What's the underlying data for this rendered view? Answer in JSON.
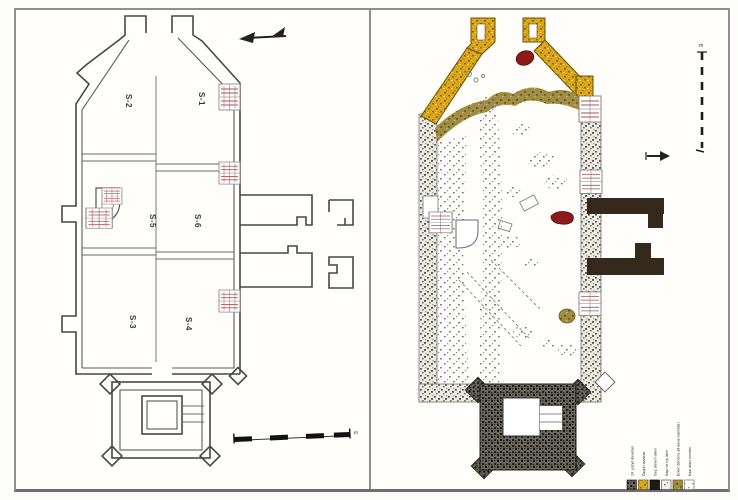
{
  "figure": {
    "title": "church-excavation-plans",
    "panel_count": 2
  },
  "left_plan": {
    "description": "line drawing of church plan with excavation trenches",
    "trenches": [
      {
        "label": "S-2"
      },
      {
        "label": "S-1"
      },
      {
        "label": "S-5"
      },
      {
        "label": "S-6"
      },
      {
        "label": "S-3"
      },
      {
        "label": "S-4"
      }
    ],
    "scale_unit": "m",
    "north_icon": "north-arrow"
  },
  "right_plan": {
    "description": "colored stone-by-stone excavation plan of same church",
    "scale_unit": "m",
    "north_icon": "north-arrow",
    "colors": {
      "yellow_walls": "#d9a61e",
      "olive_remains": "#a08c42",
      "dark_additions": "#34291a",
      "solid_black": "#1d1a12",
      "red_features": "#8c1a1a",
      "gray_walls": "#8e8c84"
    },
    "legend": {
      "entries": [
        {
          "label": "19. yüzyıl duvarları",
          "swatch": "dark-stipple"
        },
        {
          "label": "Özgün duvarlar",
          "swatch": "yellow-stipple"
        },
        {
          "label": "Geç dönem ekleri",
          "swatch": "solid-black"
        },
        {
          "label": "Kapı ve niş izleri",
          "swatch": "light"
        },
        {
          "label": "Erken döneme ait duvar kalıntıları",
          "swatch": "olive-stipple"
        },
        {
          "label": "Kazı alanı sınırları",
          "swatch": "white-stipple"
        }
      ]
    }
  }
}
